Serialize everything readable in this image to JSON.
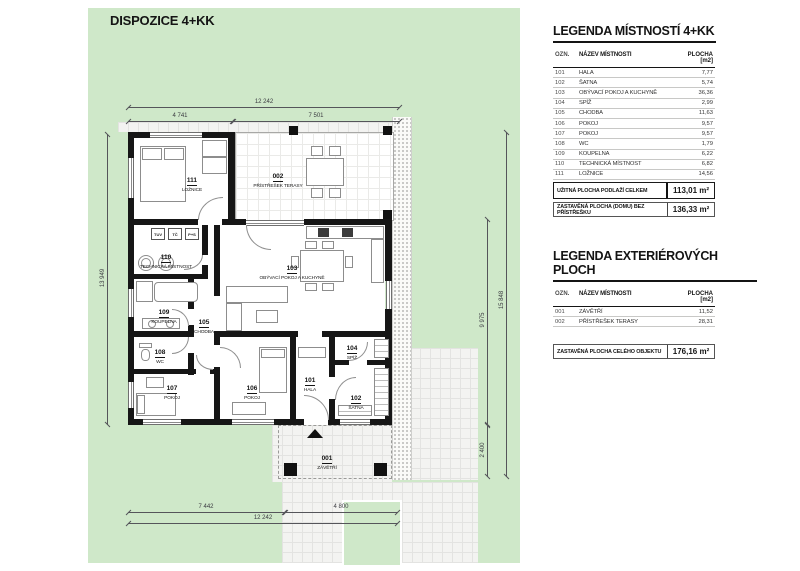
{
  "title": "DISPOZICE 4+KK",
  "plan": {
    "rooms": [
      {
        "num": "111",
        "name": "LOŽNICE"
      },
      {
        "num": "002",
        "name": "PŘÍSTŘEŠEK TERASY"
      },
      {
        "num": "110",
        "name": "TECHNICKÁ MÍSTNOST"
      },
      {
        "num": "103",
        "name": "OBÝVACÍ POKOJ A KUCHYNĚ"
      },
      {
        "num": "109",
        "name": "KOUPELNA"
      },
      {
        "num": "105",
        "name": "CHODBA"
      },
      {
        "num": "108",
        "name": "WC"
      },
      {
        "num": "104",
        "name": "SPÍŽ"
      },
      {
        "num": "107",
        "name": "POKOJ"
      },
      {
        "num": "106",
        "name": "POKOJ"
      },
      {
        "num": "101",
        "name": "HALA"
      },
      {
        "num": "102",
        "name": "ŠATNA"
      },
      {
        "num": "001",
        "name": "ZÁVĚTŘÍ"
      }
    ],
    "appliances": [
      "TUV",
      "TČ",
      "P+S"
    ],
    "dimensions": {
      "top_total": "12 242",
      "top_left": "4 741",
      "top_right": "7 501",
      "left": "13 949",
      "right_inner": "9 975",
      "right_lower": "2 400",
      "right_outer": "15 848",
      "bottom_left": "7 442",
      "bottom_right": "4 800",
      "bottom_total": "12 242"
    }
  },
  "legend_rooms": {
    "title": "LEGENDA MÍSTNOSTÍ 4+KK",
    "headers": {
      "code": "OZN.",
      "name": "NÁZEV MÍSTNOSTI",
      "area": "PLOCHA [m2]"
    },
    "rows": [
      {
        "code": "101",
        "name": "HALA",
        "area": "7,77"
      },
      {
        "code": "102",
        "name": "ŠATNA",
        "area": "5,74"
      },
      {
        "code": "103",
        "name": "OBÝVACÍ POKOJ A KUCHYNĚ",
        "area": "36,36"
      },
      {
        "code": "104",
        "name": "SPÍŽ",
        "area": "2,99"
      },
      {
        "code": "105",
        "name": "CHODBA",
        "area": "11,63"
      },
      {
        "code": "106",
        "name": "POKOJ",
        "area": "9,57"
      },
      {
        "code": "107",
        "name": "POKOJ",
        "area": "9,57"
      },
      {
        "code": "108",
        "name": "WC",
        "area": "1,79"
      },
      {
        "code": "109",
        "name": "KOUPELNA",
        "area": "6,22"
      },
      {
        "code": "110",
        "name": "TECHNICKÁ MÍSTNOST",
        "area": "6,82"
      },
      {
        "code": "111",
        "name": "LOŽNICE",
        "area": "14,56"
      }
    ],
    "summary": [
      {
        "label": "UŽITNÁ PLOCHA PODLAŽÍ CELKEM",
        "value": "113,01 m²"
      },
      {
        "label": "ZASTAVĚNÁ PLOCHA (DOMU) BEZ PŘÍSTŘEŠKU",
        "value": "136,33 m²"
      }
    ]
  },
  "legend_exterior": {
    "title": "LEGENDA EXTERIÉROVÝCH PLOCH",
    "headers": {
      "code": "OZN.",
      "name": "NÁZEV MÍSTNOSTI",
      "area": "PLOCHA [m2]"
    },
    "rows": [
      {
        "code": "001",
        "name": "ZÁVĚTŘÍ",
        "area": "11,52"
      },
      {
        "code": "002",
        "name": "PŘÍSTŘEŠEK TERASY",
        "area": "28,31"
      }
    ],
    "summary": [
      {
        "label": "ZASTAVĚNÁ PLOCHA CELÉHO OBJEKTU",
        "value": "176,16 m²"
      }
    ]
  },
  "colors": {
    "grass": "#cfe8c9",
    "paving": "#f3f3f1",
    "wall": "#161616",
    "background": "#ffffff"
  }
}
